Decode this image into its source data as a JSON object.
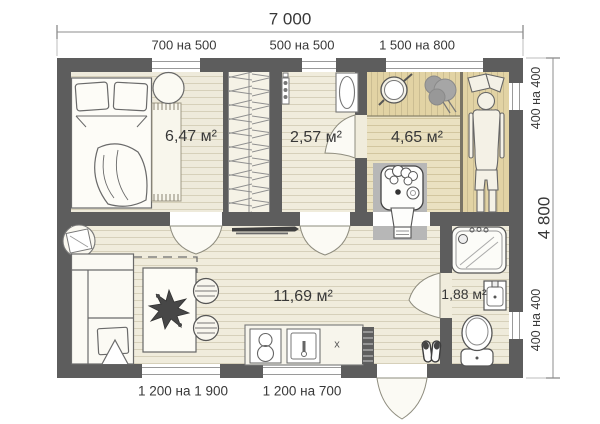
{
  "dimensions": {
    "overall_width": "7 000",
    "overall_height": "4 800"
  },
  "windows": {
    "top": [
      "700 на 500",
      "500 на 500",
      "1 500 на 800"
    ],
    "right_top": "400 на 400",
    "right_bottom": "400 на 400",
    "bottom": [
      "1 200 на 1 900",
      "1 200 на 700"
    ]
  },
  "rooms": {
    "bedroom_area": "6,47 м²",
    "washroom_area": "2,57 м²",
    "sauna_area": "4,65 м²",
    "living_area": "11,69 м²",
    "bathroom_area": "1,88 м²"
  },
  "annotations": {
    "counter_mark": "x"
  },
  "colors": {
    "wall": "#5d5d5d",
    "floor_light": "#f0ecdc",
    "floor_sauna": "#eae1c1",
    "bench_wood": "#e2d3a4",
    "stove_pad": "#b7b7b7"
  }
}
